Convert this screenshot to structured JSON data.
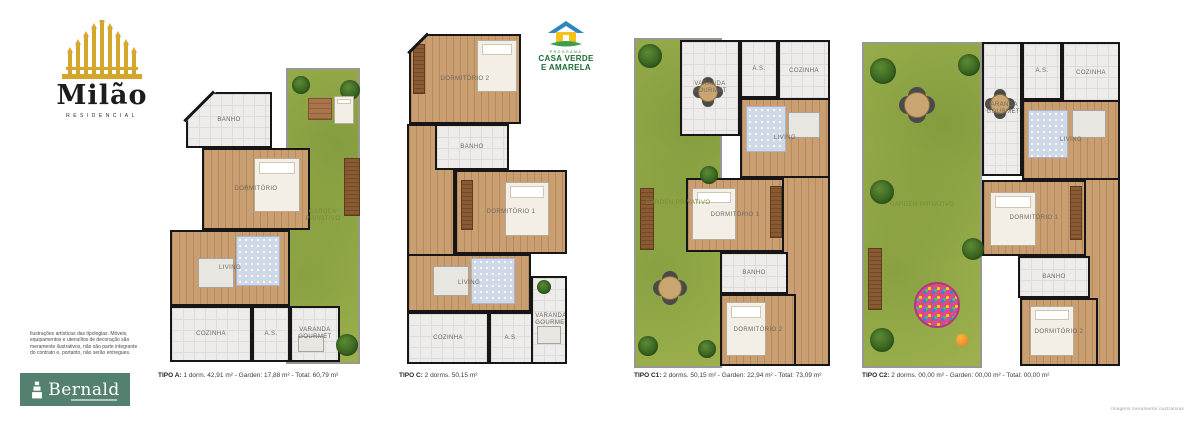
{
  "brand": {
    "name": "Milão",
    "subtitle": "RESIDENCIAL"
  },
  "disclaimer": "Ilustrações artísticas das tipologias. Móveis, equipamentos e utensílios de decoração são meramente ilustrativos, não são parte integrante do contrato e, portanto, não serão entregues.",
  "developer": {
    "name": "Bernald"
  },
  "program": {
    "line1": "PROGRAMA",
    "line2": "CASA VERDE",
    "line3": "E AMARELA"
  },
  "fine_print": "Imagens meramente ilustrativas",
  "colors": {
    "brand_gold": "#D5A62C",
    "developer_green": "#54806F",
    "program_green": "#1B6B33",
    "roof_blue": "#2E86C1",
    "house_yellow": "#F2C21F",
    "lawn": "#9CB14D",
    "wood_floor": "#C99F72",
    "tile_floor": "#EDECEA",
    "wall": "#161616"
  },
  "plans": [
    {
      "id": "tipo-a",
      "caption_bold": "TIPO A:",
      "caption_rest": " 1 dorm. 42,91 m² - Garden: 17,88 m² - Total: 60,79 m²",
      "x": 158,
      "y": 62,
      "w": 204,
      "h": 306,
      "rooms": [
        {
          "label": "GARDEN PRIVATIVO",
          "floor": "garden",
          "x": 128,
          "y": 6,
          "w": 74,
          "h": 296
        },
        {
          "label": "BANHO",
          "floor": "tile",
          "x": 28,
          "y": 30,
          "w": 86,
          "h": 56
        },
        {
          "label": "DORMITÓRIO",
          "floor": "wood",
          "x": 44,
          "y": 86,
          "w": 108,
          "h": 82
        },
        {
          "label": "LIVING",
          "floor": "wood",
          "x": 12,
          "y": 168,
          "w": 120,
          "h": 76
        },
        {
          "label": "COZINHA",
          "floor": "tile",
          "x": 12,
          "y": 244,
          "w": 82,
          "h": 56
        },
        {
          "label": "A.S.",
          "floor": "tile",
          "x": 94,
          "y": 244,
          "w": 38,
          "h": 56
        },
        {
          "label": "VARANDA GOURMET",
          "floor": "tile",
          "x": 132,
          "y": 244,
          "w": 50,
          "h": 56
        }
      ],
      "deco": [
        {
          "t": "tree",
          "x": 134,
          "y": 14,
          "w": 18
        },
        {
          "t": "tree",
          "x": 182,
          "y": 18,
          "w": 20
        },
        {
          "t": "deck",
          "x": 150,
          "y": 36,
          "w": 24,
          "h": 22
        },
        {
          "t": "bed",
          "x": 176,
          "y": 34,
          "w": 20,
          "h": 28
        },
        {
          "t": "bench",
          "x": 186,
          "y": 96,
          "w": 16,
          "h": 58
        },
        {
          "t": "bed",
          "x": 96,
          "y": 96,
          "w": 46,
          "h": 54
        },
        {
          "t": "rug",
          "x": 78,
          "y": 174,
          "w": 44,
          "h": 50
        },
        {
          "t": "table",
          "x": 40,
          "y": 196,
          "w": 36,
          "h": 30
        },
        {
          "t": "table",
          "x": 140,
          "y": 274,
          "w": 26,
          "h": 16
        },
        {
          "t": "tree",
          "x": 178,
          "y": 272,
          "w": 22
        },
        {
          "t": "cut",
          "x": 28,
          "y": 30,
          "w": 30
        },
        {
          "t": "cutline",
          "x": 20,
          "y": 43,
          "w": 42
        }
      ]
    },
    {
      "id": "tipo-c",
      "caption_bold": "TIPO C:",
      "caption_rest": " 2 dorms. 50,15 m²",
      "x": 399,
      "y": 28,
      "w": 170,
      "h": 340,
      "rooms": [
        {
          "label": "DORMITÓRIO 2",
          "floor": "wood",
          "x": 10,
          "y": 6,
          "w": 112,
          "h": 90
        },
        {
          "label": "",
          "floor": "wood",
          "x": 8,
          "y": 96,
          "w": 48,
          "h": 132
        },
        {
          "label": "BANHO",
          "floor": "tile",
          "x": 36,
          "y": 96,
          "w": 74,
          "h": 46
        },
        {
          "label": "DORMITÓRIO 1",
          "floor": "wood",
          "x": 56,
          "y": 142,
          "w": 112,
          "h": 84
        },
        {
          "label": "LIVING",
          "floor": "wood",
          "x": 8,
          "y": 226,
          "w": 124,
          "h": 58
        },
        {
          "label": "COZINHA",
          "floor": "tile",
          "x": 8,
          "y": 284,
          "w": 82,
          "h": 52
        },
        {
          "label": "A.S.",
          "floor": "tile",
          "x": 90,
          "y": 284,
          "w": 44,
          "h": 52
        },
        {
          "label": "VARANDA GOURMET",
          "floor": "tile",
          "x": 132,
          "y": 248,
          "w": 36,
          "h": 88
        }
      ],
      "deco": [
        {
          "t": "bed",
          "x": 78,
          "y": 12,
          "w": 40,
          "h": 52
        },
        {
          "t": "bench",
          "x": 14,
          "y": 16,
          "w": 12,
          "h": 50
        },
        {
          "t": "bed",
          "x": 106,
          "y": 154,
          "w": 44,
          "h": 54
        },
        {
          "t": "bench",
          "x": 62,
          "y": 152,
          "w": 12,
          "h": 50
        },
        {
          "t": "rug",
          "x": 72,
          "y": 230,
          "w": 44,
          "h": 46
        },
        {
          "t": "table",
          "x": 34,
          "y": 238,
          "w": 36,
          "h": 30
        },
        {
          "t": "table",
          "x": 138,
          "y": 298,
          "w": 24,
          "h": 18
        },
        {
          "t": "tree",
          "x": 138,
          "y": 252,
          "w": 14
        },
        {
          "t": "cut",
          "x": 10,
          "y": 6,
          "w": 20
        },
        {
          "t": "cutline",
          "x": 5,
          "y": 14,
          "w": 28
        }
      ]
    },
    {
      "id": "tipo-c1",
      "caption_bold": "TIPO C1:",
      "caption_rest": " 2 dorms. 50,15 m² - Garden: 22,94 m² - Total: 73,09 m²",
      "x": 634,
      "y": 30,
      "w": 196,
      "h": 338,
      "rooms": [
        {
          "label": "GARDEN PRIVATIVO",
          "floor": "garden",
          "x": 0,
          "y": 8,
          "w": 88,
          "h": 330
        },
        {
          "label": "",
          "floor": "wood",
          "x": 144,
          "y": 72,
          "w": 52,
          "h": 264
        },
        {
          "label": "VARANDA GOURMET",
          "floor": "tile",
          "x": 46,
          "y": 10,
          "w": 60,
          "h": 96
        },
        {
          "label": "A.S.",
          "floor": "tile",
          "x": 106,
          "y": 10,
          "w": 38,
          "h": 58
        },
        {
          "label": "COZINHA",
          "floor": "tile",
          "x": 144,
          "y": 10,
          "w": 52,
          "h": 62
        },
        {
          "label": "LIVING",
          "floor": "wood",
          "x": 106,
          "y": 68,
          "w": 90,
          "h": 80
        },
        {
          "label": "DORMITÓRIO 1",
          "floor": "wood",
          "x": 52,
          "y": 148,
          "w": 98,
          "h": 74
        },
        {
          "label": "BANHO",
          "floor": "tile",
          "x": 86,
          "y": 222,
          "w": 68,
          "h": 42
        },
        {
          "label": "DORMITÓRIO 2",
          "floor": "wood",
          "x": 86,
          "y": 264,
          "w": 76,
          "h": 72
        }
      ],
      "deco": [
        {
          "t": "tree",
          "x": 4,
          "y": 14,
          "w": 24
        },
        {
          "t": "bench",
          "x": 6,
          "y": 158,
          "w": 14,
          "h": 62
        },
        {
          "t": "rtable",
          "x": 24,
          "y": 246,
          "w": 24
        },
        {
          "t": "tree",
          "x": 4,
          "y": 306,
          "w": 20
        },
        {
          "t": "tree",
          "x": 64,
          "y": 310,
          "w": 18
        },
        {
          "t": "tree",
          "x": 66,
          "y": 136,
          "w": 18
        },
        {
          "t": "rtable",
          "x": 64,
          "y": 52,
          "w": 20
        },
        {
          "t": "rug",
          "x": 112,
          "y": 76,
          "w": 40,
          "h": 46
        },
        {
          "t": "table",
          "x": 154,
          "y": 82,
          "w": 32,
          "h": 26
        },
        {
          "t": "bed",
          "x": 58,
          "y": 158,
          "w": 44,
          "h": 52
        },
        {
          "t": "bench",
          "x": 136,
          "y": 156,
          "w": 12,
          "h": 52
        },
        {
          "t": "bed",
          "x": 92,
          "y": 272,
          "w": 40,
          "h": 54
        }
      ]
    },
    {
      "id": "tipo-c2",
      "caption_bold": "TIPO C2:",
      "caption_rest": " 2 dorms. 00,00 m² - Garden: 00,00 m² - Total: 00,00 m²",
      "x": 862,
      "y": 30,
      "w": 258,
      "h": 338,
      "rooms": [
        {
          "label": "GARDEN PRIVATIVO",
          "floor": "garden",
          "x": 0,
          "y": 12,
          "w": 120,
          "h": 326
        },
        {
          "label": "",
          "floor": "wood",
          "x": 200,
          "y": 74,
          "w": 58,
          "h": 262
        },
        {
          "label": "VARANDA GOURMET",
          "floor": "tile",
          "x": 120,
          "y": 12,
          "w": 40,
          "h": 134
        },
        {
          "label": "A.S.",
          "floor": "tile",
          "x": 160,
          "y": 12,
          "w": 40,
          "h": 58
        },
        {
          "label": "COZINHA",
          "floor": "tile",
          "x": 200,
          "y": 12,
          "w": 58,
          "h": 62
        },
        {
          "label": "LIVING",
          "floor": "wood",
          "x": 160,
          "y": 70,
          "w": 98,
          "h": 80
        },
        {
          "label": "DORMITÓRIO 1",
          "floor": "wood",
          "x": 120,
          "y": 150,
          "w": 104,
          "h": 76
        },
        {
          "label": "BANHO",
          "floor": "tile",
          "x": 156,
          "y": 226,
          "w": 72,
          "h": 42
        },
        {
          "label": "DORMITÓRIO 2",
          "floor": "wood",
          "x": 158,
          "y": 268,
          "w": 78,
          "h": 68
        }
      ],
      "deco": [
        {
          "t": "tree",
          "x": 8,
          "y": 28,
          "w": 26
        },
        {
          "t": "tree",
          "x": 96,
          "y": 24,
          "w": 22
        },
        {
          "t": "rtable",
          "x": 42,
          "y": 62,
          "w": 26
        },
        {
          "t": "tree",
          "x": 8,
          "y": 150,
          "w": 24
        },
        {
          "t": "bench",
          "x": 6,
          "y": 218,
          "w": 14,
          "h": 62
        },
        {
          "t": "ballpit",
          "x": 52,
          "y": 252,
          "w": 46
        },
        {
          "t": "ball",
          "x": 94,
          "y": 304,
          "w": 12
        },
        {
          "t": "tree",
          "x": 100,
          "y": 208,
          "w": 22
        },
        {
          "t": "tree",
          "x": 8,
          "y": 298,
          "w": 24
        },
        {
          "t": "rtable",
          "x": 128,
          "y": 64,
          "w": 20
        },
        {
          "t": "rug",
          "x": 166,
          "y": 80,
          "w": 40,
          "h": 48
        },
        {
          "t": "table",
          "x": 210,
          "y": 80,
          "w": 34,
          "h": 28
        },
        {
          "t": "bed",
          "x": 128,
          "y": 162,
          "w": 46,
          "h": 54
        },
        {
          "t": "bench",
          "x": 208,
          "y": 156,
          "w": 12,
          "h": 54
        },
        {
          "t": "bed",
          "x": 168,
          "y": 276,
          "w": 44,
          "h": 50
        }
      ]
    }
  ]
}
